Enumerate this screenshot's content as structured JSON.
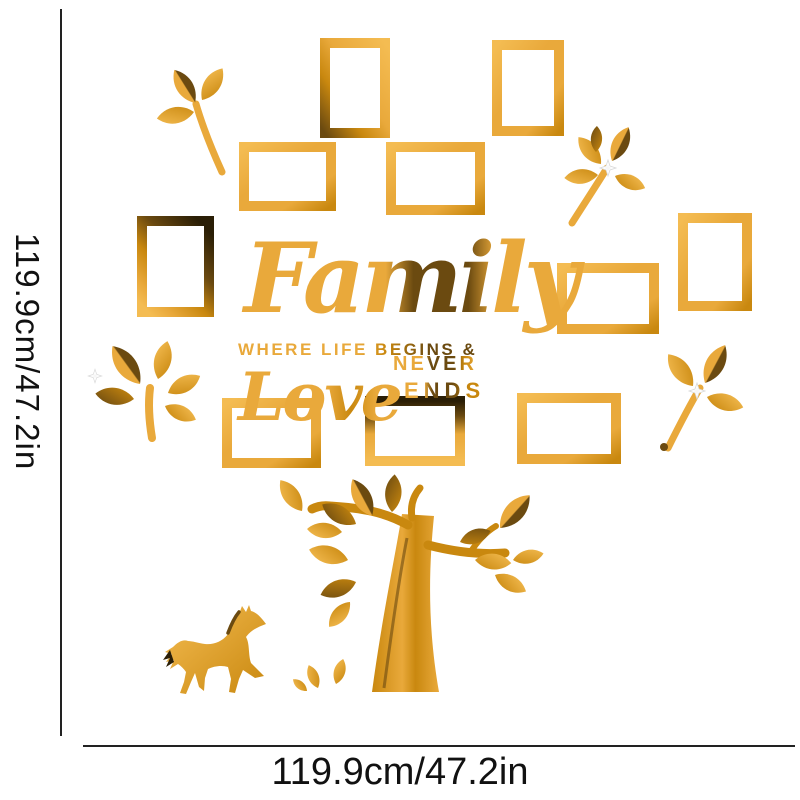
{
  "image": {
    "description": "Gold mirror acrylic family-tree photo-frame wall sticker product image with size annotations",
    "background": "#ffffff"
  },
  "dimensions": {
    "height_label": "119.9cm/47.2in",
    "width_label": "119.9cm/47.2in"
  },
  "colors": {
    "gold": "#E9A93B",
    "gold_light": "#F4BC52",
    "gold_deep": "#C9880F",
    "gold_dark": "#6B4A10",
    "gold_black": "#2A1E06",
    "line": "#222222",
    "text": "#111111"
  },
  "decal": {
    "text": {
      "family": "Family",
      "tagline": "WHERE LIFE BEGINS &",
      "love": "Love",
      "never": "NEVER",
      "ends": "ENDS"
    },
    "frames": [
      {
        "x": 320,
        "y": 38,
        "w": 70,
        "h": 100,
        "orientation": "portrait",
        "tone": "mixed"
      },
      {
        "x": 492,
        "y": 40,
        "w": 72,
        "h": 96,
        "orientation": "portrait",
        "tone": "light"
      },
      {
        "x": 239,
        "y": 142,
        "w": 97,
        "h": 69,
        "orientation": "landscape",
        "tone": "light"
      },
      {
        "x": 386,
        "y": 142,
        "w": 99,
        "h": 73,
        "orientation": "landscape",
        "tone": "light"
      },
      {
        "x": 137,
        "y": 216,
        "w": 77,
        "h": 101,
        "orientation": "portrait",
        "tone": "dark"
      },
      {
        "x": 678,
        "y": 213,
        "w": 74,
        "h": 98,
        "orientation": "portrait",
        "tone": "light"
      },
      {
        "x": 557,
        "y": 263,
        "w": 102,
        "h": 71,
        "orientation": "landscape",
        "tone": "light"
      },
      {
        "x": 222,
        "y": 398,
        "w": 99,
        "h": 70,
        "orientation": "landscape",
        "tone": "light"
      },
      {
        "x": 365,
        "y": 396,
        "w": 100,
        "h": 70,
        "orientation": "landscape",
        "tone": "topdark"
      },
      {
        "x": 517,
        "y": 393,
        "w": 104,
        "h": 71,
        "orientation": "landscape",
        "tone": "light"
      }
    ]
  }
}
